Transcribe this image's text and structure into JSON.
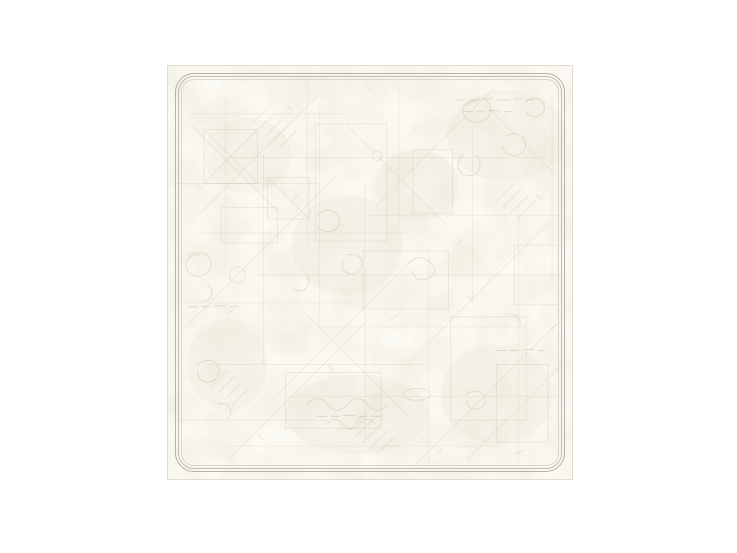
{
  "window": {
    "background_color": "#ffffff"
  },
  "artwork": {
    "name": "faded-parchment-sketch-panel",
    "description": "Square panel of aged off-white parchment covered in faint sepia sketch lines, scribbles, dash marks and mottled stains, enclosed by a thin rounded double-line gray border frame. No readable text.",
    "colors": {
      "window_bg": "#ffffff",
      "canvas": "#fcfbf5",
      "mottle": "#cfc2a6",
      "sketch": "#bdae8e",
      "frame_outer": "#aeaba3",
      "frame_mid": "#b6b3ab",
      "frame_faint": "#d2cfc7",
      "panel_edge": "#e0ddd5"
    }
  }
}
